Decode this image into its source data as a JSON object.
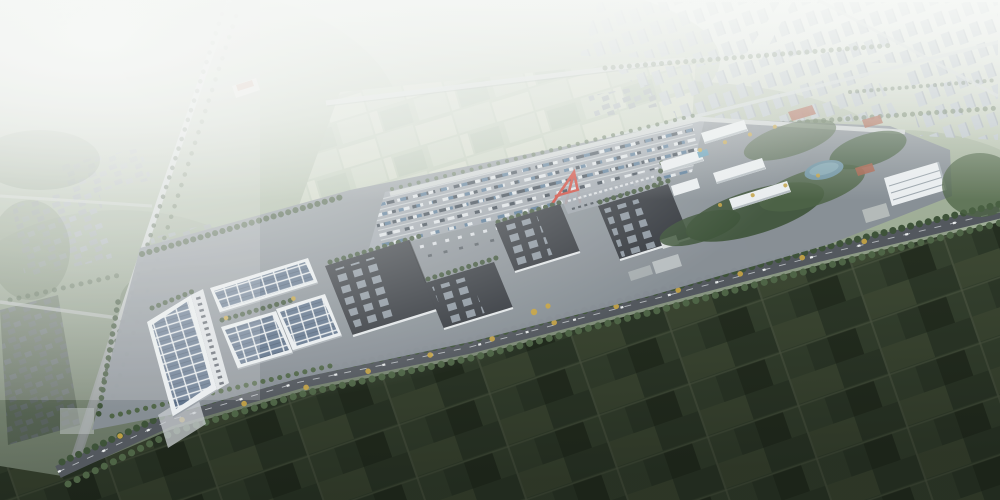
{
  "scene": {
    "title": "Aerial rendering of an industrial logistics park",
    "description": "Bird's-eye architectural rendering: a diagonal industrial park strip with solar-roofed warehouses, dark skylight-roofed warehouses, a rail container yard with a red gantry crane, a white office campus with a pond and park, hazy residential city blocks in the background and dark patchwork farmland in the foreground, crossed by tree-lined roads."
  },
  "palette": {
    "haze": "#f2f5f2",
    "landLight": "#c2cbb8",
    "landMid": "#a3b29b",
    "landDeep": "#8b9c84",
    "treeDark": "#3e5339",
    "treeMid": "#4e6446",
    "treeYellow": "#c2a144",
    "cityTower": "#b9c2c8",
    "cityTowerShade": "#a2abb2",
    "lowrise": "#9aa3a7",
    "roadLight": "#cdd3d2",
    "roadDark": "#53585e",
    "pavement": "#878e96",
    "yardPavement": "#9aa1a9",
    "roofDark": "#33373d",
    "skylight": "#95a0aa",
    "solarBlue": "#5c7089",
    "solarDark": "#47586e",
    "whiteTrim": "#e9edef",
    "craneRed": "#cc3b2e",
    "pond": "#6f93a2",
    "pool": "#5f9ab4",
    "containerBlue": "#4a6e8e",
    "containerNavy": "#303b47",
    "containerWhite": "#dde2e6",
    "plazaRed": "#a8604a",
    "fbA": "#313d2c",
    "fbB": "#3a4733",
    "fbC": "#273122",
    "fbD": "#434f38",
    "fbE": "#55604a",
    "bfA": "#b5c1a8",
    "bfB": "#a3b398",
    "bfC": "#c2c9b2",
    "bfD": "#93a68c"
  }
}
